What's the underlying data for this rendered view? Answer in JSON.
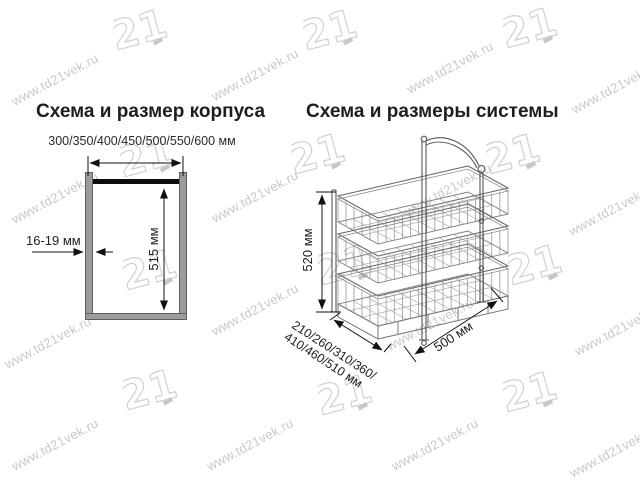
{
  "watermark": {
    "text": "www.td21vek.ru",
    "logo": "21"
  },
  "left_diagram": {
    "title": "Схема и размер корпуса",
    "width_options": "300/350/400/450/500/550/600 мм",
    "inner_height": "515 мм",
    "panel_thickness": "16-19 мм"
  },
  "right_diagram": {
    "title": "Схема и размеры системы",
    "height": "520 мм",
    "depth_options_line1": "210/260/310/360/",
    "depth_options_line2": "410/460/510 мм",
    "width": "500 мм"
  }
}
